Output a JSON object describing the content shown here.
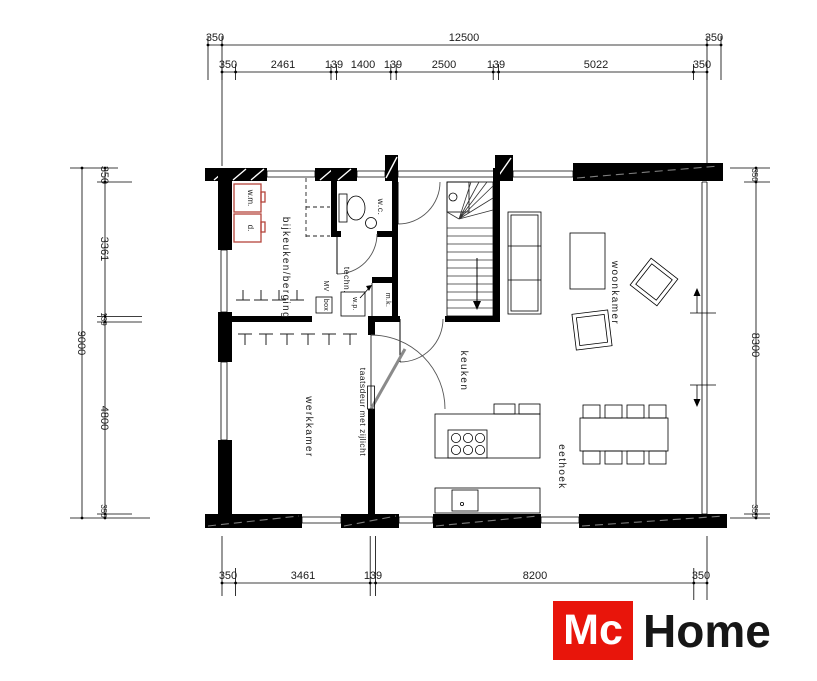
{
  "logo": {
    "mc": "Mc",
    "home": "Home",
    "brand_red": "#e8150b"
  },
  "dims": {
    "top_outer": [
      "350",
      "12500",
      "350"
    ],
    "top_inner": [
      "350",
      "2461",
      "139",
      "1400",
      "139",
      "2500",
      "139",
      "5022",
      "350"
    ],
    "left_outer": "9000",
    "left_inner": [
      "350",
      "3361",
      "139",
      "4800",
      "350"
    ],
    "right": [
      "350",
      "8300",
      "350"
    ],
    "bottom": [
      "350",
      "3461",
      "139",
      "8200",
      "350"
    ]
  },
  "rooms": {
    "bijkeuken": "bijkeuken/berging",
    "wc": "w.c.",
    "techn": "techn.",
    "keuken": "keuken",
    "woonkamer": "woonkamer",
    "werkkamer": "werkkamer",
    "eethoek": "eethoek"
  },
  "fixtures": {
    "wm": "w.m.",
    "d": "d.",
    "mv": "MV",
    "box": "box",
    "wp": "w.p.",
    "mk": "m.k.",
    "door_note": "taatsdeur met zijlicht"
  }
}
